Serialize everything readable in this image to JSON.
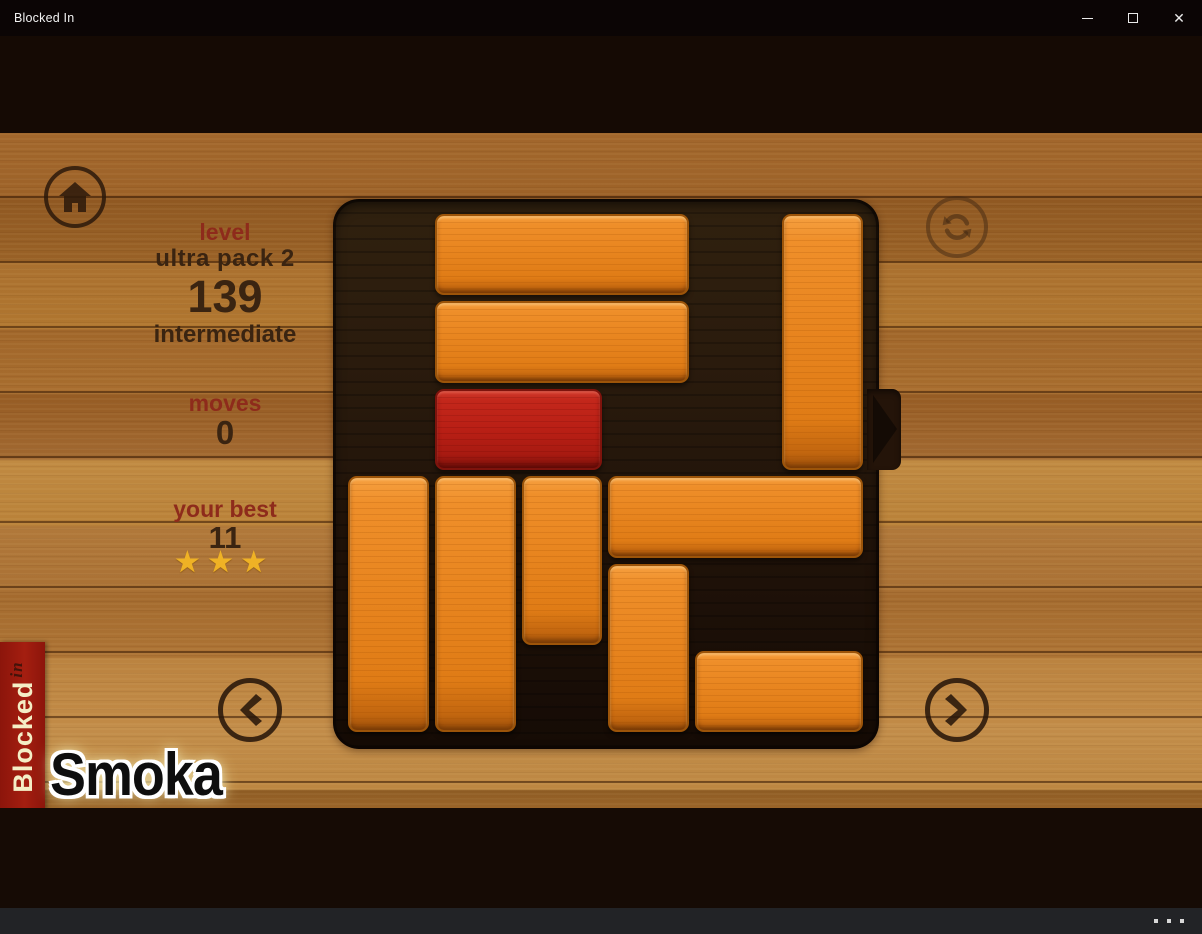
{
  "window": {
    "title": "Blocked In",
    "close_glyph": "✕"
  },
  "hud": {
    "level_label": "level",
    "pack_name": "ultra pack 2",
    "level_number": "139",
    "difficulty": "intermediate",
    "moves_label": "moves",
    "moves_value": "0",
    "best_label": "your best",
    "best_value": "11",
    "stars_count": 3,
    "stars_display": "★★★"
  },
  "ribbon": {
    "brand": "Blocked",
    "brand_suffix": "in"
  },
  "watermark": "Smoka",
  "statusbar": {
    "more_icon": "see-more-dots"
  },
  "icons": {
    "home": "house-icon",
    "restart": "circular-arrows-icon",
    "prev": "chevron-left-icon",
    "next": "chevron-right-icon",
    "minimize": "minimize-dash-icon",
    "maximize": "maximize-square-icon",
    "close": "close-x-icon",
    "star": "★"
  },
  "board": {
    "rows": 6,
    "cols": 6,
    "exit": {
      "side": "right",
      "row": 2
    },
    "blocks": [
      {
        "id": "h3-a",
        "row": 0,
        "col": 1,
        "len": 3,
        "dir": "h",
        "color": "orange"
      },
      {
        "id": "h3-b",
        "row": 1,
        "col": 1,
        "len": 3,
        "dir": "h",
        "color": "orange"
      },
      {
        "id": "player",
        "row": 2,
        "col": 1,
        "len": 2,
        "dir": "h",
        "color": "red"
      },
      {
        "id": "v3-a",
        "row": 0,
        "col": 5,
        "len": 3,
        "dir": "v",
        "color": "orange"
      },
      {
        "id": "v3-b",
        "row": 3,
        "col": 0,
        "len": 3,
        "dir": "v",
        "color": "orange"
      },
      {
        "id": "v3-c",
        "row": 3,
        "col": 1,
        "len": 3,
        "dir": "v",
        "color": "orange"
      },
      {
        "id": "v2-a",
        "row": 3,
        "col": 2,
        "len": 2,
        "dir": "v",
        "color": "orange"
      },
      {
        "id": "h3-c",
        "row": 3,
        "col": 3,
        "len": 3,
        "dir": "h",
        "color": "orange"
      },
      {
        "id": "v2-b",
        "row": 4,
        "col": 3,
        "len": 2,
        "dir": "v",
        "color": "orange"
      },
      {
        "id": "h2-a",
        "row": 5,
        "col": 4,
        "len": 2,
        "dir": "h",
        "color": "orange"
      }
    ]
  },
  "colors": {
    "accent_orange": "#e8851f",
    "player_red": "#b91f15",
    "star_gold": "#efb225",
    "hud_label_red": "#8e2b1b",
    "hud_text_brown": "#3a2411",
    "ribbon_red": "#a41e10"
  }
}
